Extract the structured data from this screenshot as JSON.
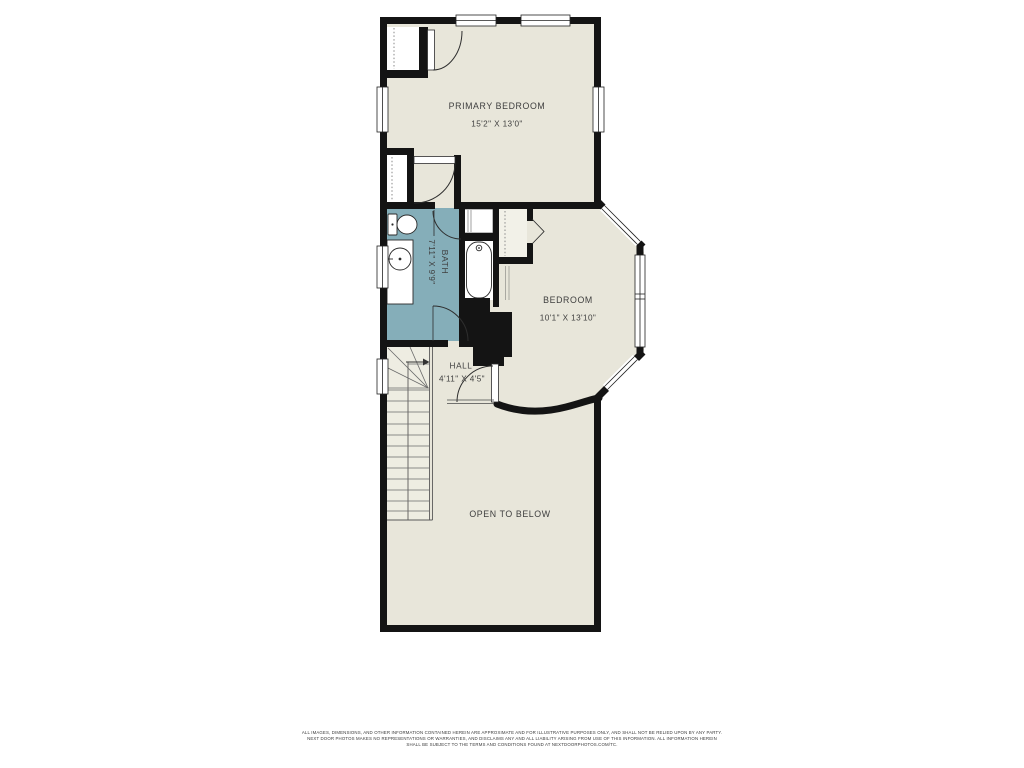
{
  "plan": {
    "colors": {
      "floor": "#e8e6da",
      "bath": "#85aeb9",
      "wall": "#141414",
      "stair_fill": "#eeede2",
      "closet_fill": "#ffffff"
    },
    "rooms": [
      {
        "id": "primary-bedroom",
        "name": "PRIMARY BEDROOM",
        "dimensions": "15'2\" X 13'0\""
      },
      {
        "id": "bath",
        "name": "BATH",
        "dimensions": "7'11\" X 9'9\""
      },
      {
        "id": "bedroom",
        "name": "BEDROOM",
        "dimensions": "10'1\" X 13'10\""
      },
      {
        "id": "hall",
        "name": "HALL",
        "dimensions": "4'11\" X 4'5\""
      },
      {
        "id": "open-to-below",
        "name": "OPEN TO BELOW",
        "dimensions": ""
      }
    ],
    "features": [
      "stairs",
      "bay-window",
      "bathtub",
      "toilet",
      "vanity-sink",
      "linen-closet",
      "primary-closet-1",
      "primary-closet-2",
      "bedroom-closet"
    ]
  },
  "footer": {
    "line1": "ALL IMAGES, DIMENSIONS, AND OTHER INFORMATION CONTAINED HEREIN ARE APPROXIMATE AND FOR ILLUSTRATIVE PURPOSES ONLY, AND SHALL NOT BE RELIED UPON BY ANY PARTY.",
    "line2": "NEXT DOOR PHOTOS MAKES NO REPRESENTATIONS OR WARRANTIES, AND DISCLAIMS ANY AND ALL LIABILITY ARISING FROM USE OF THIS INFORMATION. ALL INFORMATION HEREIN",
    "line3": "SHALL BE SUBJECT TO THE TERMS AND CONDITIONS FOUND AT NEXTDOORPHOTOS.COM/TC."
  }
}
